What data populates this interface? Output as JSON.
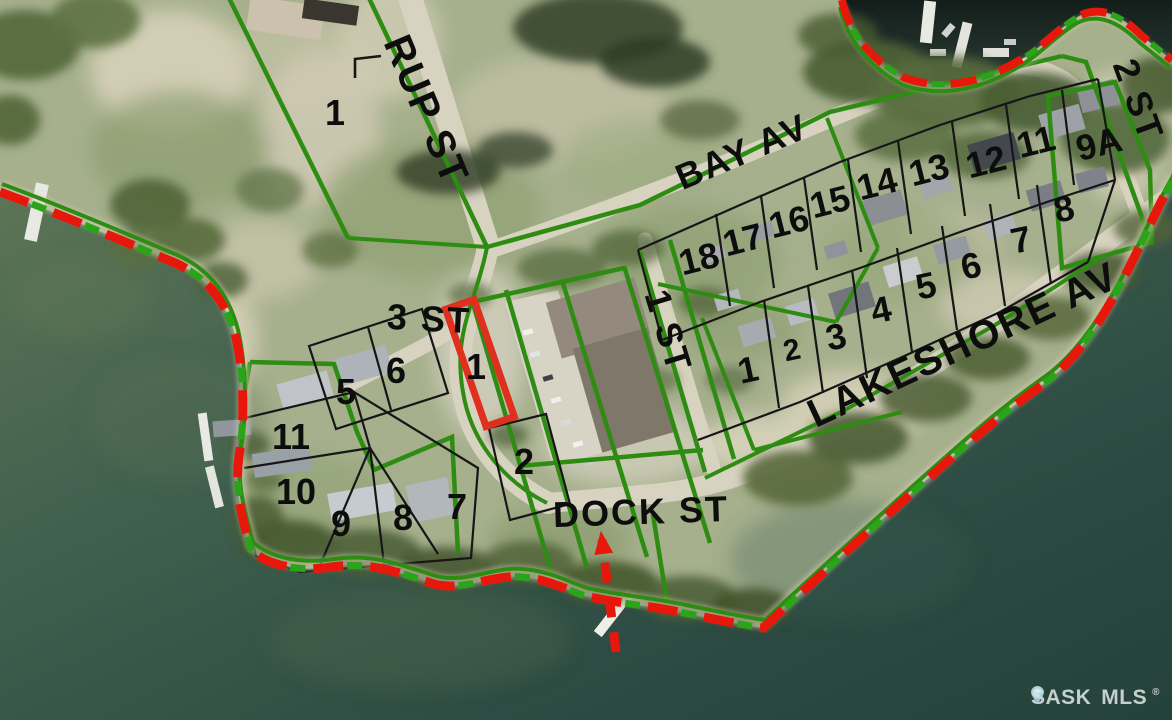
{
  "map": {
    "watermark": {
      "left": "SASK",
      "right": "MLS",
      "registered": "®"
    },
    "streets": [
      {
        "id": "rup-st",
        "label": "RUP ST",
        "x": 426,
        "y": 110,
        "rot": 67,
        "size": 40
      },
      {
        "id": "bay-av",
        "label": "BAY AV",
        "x": 742,
        "y": 152,
        "rot": -23,
        "size": 36
      },
      {
        "id": "2-st",
        "label": "2 ST",
        "x": 1138,
        "y": 100,
        "rot": 70,
        "size": 36
      },
      {
        "id": "1-st",
        "label": "1 ST",
        "x": 668,
        "y": 331,
        "rot": 73,
        "size": 36
      },
      {
        "id": "3-st",
        "label": "3 ST",
        "x": 429,
        "y": 319,
        "rot": 3,
        "size": 36
      },
      {
        "id": "dock-st",
        "label": "DOCK ST",
        "x": 641,
        "y": 512,
        "rot": -2,
        "size": 36
      },
      {
        "id": "lakeshore-av",
        "label": "LAKESHORE AV",
        "x": 963,
        "y": 345,
        "rot": -25,
        "size": 40
      }
    ],
    "lots": [
      {
        "label": "1",
        "x": 335,
        "y": 113
      },
      {
        "label": "5",
        "x": 346,
        "y": 392
      },
      {
        "label": "6",
        "x": 396,
        "y": 371
      },
      {
        "label": "11",
        "x": 291,
        "y": 437
      },
      {
        "label": "10",
        "x": 296,
        "y": 492
      },
      {
        "label": "9",
        "x": 341,
        "y": 524
      },
      {
        "label": "8",
        "x": 403,
        "y": 518
      },
      {
        "label": "7",
        "x": 457,
        "y": 507
      },
      {
        "label": "2",
        "x": 524,
        "y": 462
      },
      {
        "label": "1",
        "x": 748,
        "y": 370,
        "rot": -12
      },
      {
        "label": "2",
        "x": 792,
        "y": 351,
        "rot": -12,
        "size": 30
      },
      {
        "label": "3",
        "x": 836,
        "y": 337,
        "rot": -12
      },
      {
        "label": "4",
        "x": 881,
        "y": 310,
        "rot": -12
      },
      {
        "label": "5",
        "x": 926,
        "y": 286,
        "rot": -12
      },
      {
        "label": "6",
        "x": 971,
        "y": 266,
        "rot": -12
      },
      {
        "label": "7",
        "x": 1021,
        "y": 240,
        "rot": -12
      },
      {
        "label": "8",
        "x": 1064,
        "y": 209,
        "rot": -12
      },
      {
        "label": "18",
        "x": 699,
        "y": 259,
        "rot": -14
      },
      {
        "label": "17",
        "x": 743,
        "y": 240,
        "rot": -14
      },
      {
        "label": "16",
        "x": 789,
        "y": 222,
        "rot": -14
      },
      {
        "label": "15",
        "x": 830,
        "y": 202,
        "rot": -14
      },
      {
        "label": "14",
        "x": 877,
        "y": 184,
        "rot": -14
      },
      {
        "label": "13",
        "x": 929,
        "y": 170,
        "rot": -14
      },
      {
        "label": "12",
        "x": 986,
        "y": 162,
        "rot": -14
      },
      {
        "label": "11",
        "x": 1036,
        "y": 142,
        "rot": -14
      },
      {
        "label": "9A",
        "x": 1099,
        "y": 144,
        "rot": -14
      }
    ],
    "highlighted_lot": {
      "label": "1",
      "x": 476,
      "y": 367
    },
    "colors": {
      "parcel_line": "#2f8c12",
      "lot_line": "#161616",
      "boundary_dash_red": "#e8170b",
      "boundary_dash_green": "#2aa418",
      "highlight_outline": "#df2f1f",
      "street_text": "#0d0d0d",
      "water": "#2e4c43",
      "land": "#a3ae8c",
      "road": "#d8d3c1"
    }
  }
}
